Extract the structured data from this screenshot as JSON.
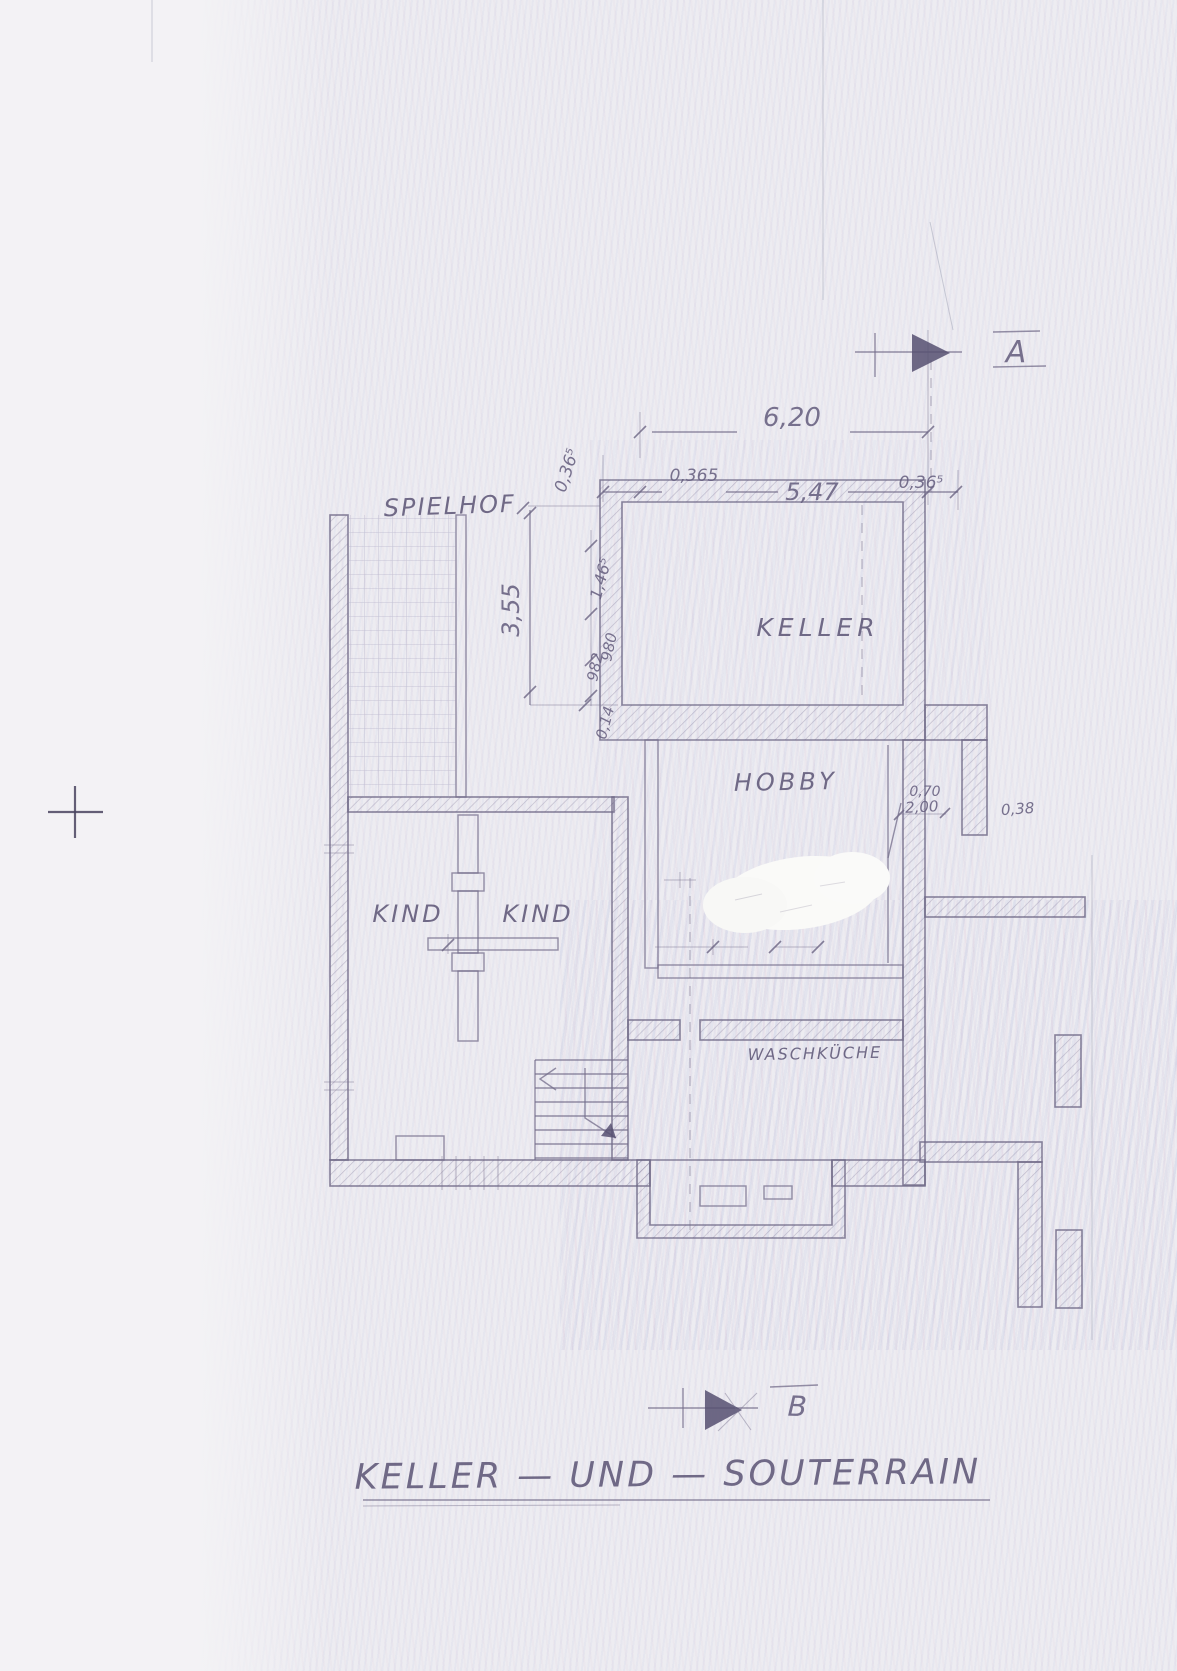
{
  "document": {
    "title": "KELLER — UND — SOUTERRAIN",
    "description": "scanned hand-drawn basement floor plan"
  },
  "section_markers": {
    "a": "A",
    "b": "B"
  },
  "rooms": {
    "spielhof": "SPIELHOF",
    "keller": "KELLER",
    "hobby": "HOBBY",
    "kind_left": "KIND",
    "kind_right": "KIND",
    "waschkueche": "WASCHKÜCHE"
  },
  "dimensions": {
    "top_total": "6,20",
    "top_left_offset": "0,365",
    "top_inner": "5,47",
    "top_right_offset": "0,36⁵",
    "side_wall": "0,36⁵",
    "spielhof_height": "3,55",
    "keller_chain_1": "1,46⁵",
    "keller_chain_2": "982",
    "keller_chain_3": "980",
    "keller_chain_4": "0,14",
    "niche_width": "0,70",
    "niche_depth": "2,00",
    "right_gap": "0,38"
  },
  "colors": {
    "paper": "#edecf1",
    "pencil": "#6f6887",
    "ink_dark": "#4a4560"
  }
}
